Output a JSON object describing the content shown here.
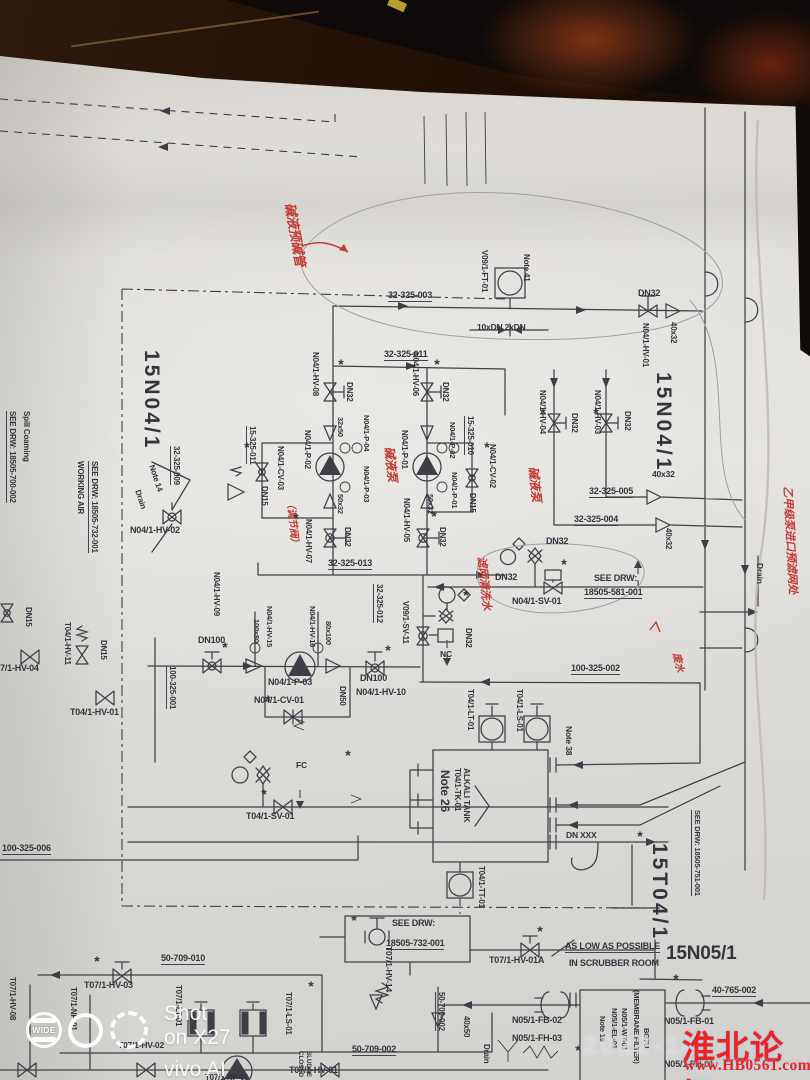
{
  "colors": {
    "ink": "#3e3e46",
    "red_pen": "#c23b33",
    "forum_red": "#ee2222",
    "paper": "#dedbd6",
    "desk": "#26140a"
  },
  "camera_watermark": {
    "badge": "WIDE",
    "line1": "Shot on X27",
    "line2": "vivo AI camera"
  },
  "forum_watermark": {
    "timestamp_partial": "2022-10-",
    "title": "淮北论坛",
    "url": "www.HB0561.com"
  },
  "diagram": {
    "labels": [
      {
        "t": "32-325-003",
        "x": 388,
        "y": 291,
        "u": 1
      },
      {
        "t": "32-325-011",
        "x": 384,
        "y": 350,
        "u": 1
      },
      {
        "t": "15N04/1",
        "x": 162,
        "y": 350,
        "r": 90,
        "s": 21,
        "ls": 3
      },
      {
        "t": "N04/1-HV-08",
        "x": 319,
        "y": 352,
        "r": 90,
        "s": 8
      },
      {
        "t": "DN32",
        "x": 353,
        "y": 382,
        "r": 90,
        "s": 8
      },
      {
        "t": "N04/1-HV-06",
        "x": 419,
        "y": 352,
        "r": 90,
        "s": 8
      },
      {
        "t": "DN32",
        "x": 449,
        "y": 382,
        "r": 90,
        "s": 8
      },
      {
        "t": "15-325-011",
        "x": 256,
        "y": 426,
        "r": 90,
        "s": 8,
        "u": 1
      },
      {
        "t": "32-325-009",
        "x": 180,
        "y": 446,
        "r": 90,
        "s": 8,
        "u": 1
      },
      {
        "t": "32x50",
        "x": 344,
        "y": 417,
        "r": 90,
        "s": 7.5
      },
      {
        "t": "N04/1-P-04",
        "x": 370,
        "y": 415,
        "r": 90,
        "s": 7.5
      },
      {
        "t": "N04/1-P-02",
        "x": 311,
        "y": 430,
        "r": 90,
        "s": 8
      },
      {
        "t": "N04/1-CV-03",
        "x": 284,
        "y": 446,
        "r": 90,
        "s": 8
      },
      {
        "t": "DN15",
        "x": 268,
        "y": 486,
        "r": 90,
        "s": 8
      },
      {
        "t": "N04/1-P-03",
        "x": 370,
        "y": 466,
        "r": 90,
        "s": 7.5
      },
      {
        "t": "50x32",
        "x": 344,
        "y": 494,
        "r": 90,
        "s": 7.5
      },
      {
        "t": "N04/1-P-01",
        "x": 408,
        "y": 430,
        "r": 90,
        "s": 8
      },
      {
        "t": "15-325-010",
        "x": 474,
        "y": 416,
        "r": 90,
        "s": 8,
        "u": 1
      },
      {
        "t": "N04/1-P-02",
        "x": 456,
        "y": 422,
        "r": 90,
        "s": 7.5
      },
      {
        "t": "N04/1-P-01",
        "x": 458,
        "y": 472,
        "r": 90,
        "s": 7.5
      },
      {
        "t": "N04/1-CV-02",
        "x": 496,
        "y": 444,
        "r": 90,
        "s": 8
      },
      {
        "t": "DN15",
        "x": 476,
        "y": 493,
        "r": 90,
        "s": 8
      },
      {
        "t": "50x32",
        "x": 434,
        "y": 494,
        "r": 90,
        "s": 7.5
      },
      {
        "t": "N04/1-HV-07",
        "x": 312,
        "y": 519,
        "r": 90,
        "s": 8
      },
      {
        "t": "DN32",
        "x": 351,
        "y": 527,
        "r": 90,
        "s": 8
      },
      {
        "t": "32-325-013",
        "x": 328,
        "y": 559,
        "u": 1
      },
      {
        "t": "N04/1-HV-05",
        "x": 410,
        "y": 498,
        "r": 90,
        "s": 8
      },
      {
        "t": "DN32",
        "x": 446,
        "y": 527,
        "r": 90,
        "s": 8
      },
      {
        "t": "V09/1-FT-01",
        "x": 488,
        "y": 250,
        "r": 90,
        "s": 8
      },
      {
        "t": "Note 41",
        "x": 530,
        "y": 254,
        "r": 90,
        "s": 8
      },
      {
        "t": "10xDN 2xDN",
        "x": 477,
        "y": 323,
        "s": 8.5
      },
      {
        "t": "DN32",
        "x": 638,
        "y": 289
      },
      {
        "t": "N04/1-HV-01",
        "x": 649,
        "y": 323,
        "r": 90,
        "s": 8
      },
      {
        "t": "40x32",
        "x": 677,
        "y": 322,
        "r": 90,
        "s": 8
      },
      {
        "t": "15N04/1",
        "x": 674,
        "y": 372,
        "r": 90,
        "s": 21,
        "ls": 3
      },
      {
        "t": "N04/1-HV-04",
        "x": 546,
        "y": 390,
        "r": 90,
        "s": 8
      },
      {
        "t": "DN32",
        "x": 578,
        "y": 413,
        "r": 90,
        "s": 8
      },
      {
        "t": "N04/1-HV-03",
        "x": 601,
        "y": 390,
        "r": 90,
        "s": 8
      },
      {
        "t": "DN32",
        "x": 631,
        "y": 411,
        "r": 90,
        "s": 8
      },
      {
        "t": "40x32",
        "x": 652,
        "y": 470,
        "s": 8.5
      },
      {
        "t": "32-325-005",
        "x": 589,
        "y": 487,
        "u": 1
      },
      {
        "t": "32-325-004",
        "x": 574,
        "y": 515,
        "u": 1
      },
      {
        "t": "40x32",
        "x": 672,
        "y": 528,
        "r": 90,
        "s": 8
      },
      {
        "t": "DN32",
        "x": 546,
        "y": 537
      },
      {
        "t": "DN32",
        "x": 495,
        "y": 573
      },
      {
        "t": "SEE DRW:",
        "x": 594,
        "y": 574
      },
      {
        "t": "18505-581-001",
        "x": 584,
        "y": 588,
        "u": 1
      },
      {
        "t": "N04/1-SV-01",
        "x": 512,
        "y": 597
      },
      {
        "t": "32-325-012",
        "x": 383,
        "y": 584,
        "r": 90,
        "s": 8,
        "u": 1
      },
      {
        "t": "V09/1-SV-11",
        "x": 409,
        "y": 601,
        "r": 90,
        "s": 8
      },
      {
        "t": "DN32",
        "x": 472,
        "y": 628,
        "r": 90,
        "s": 8
      },
      {
        "t": "NC",
        "x": 440,
        "y": 650,
        "s": 8.5
      },
      {
        "t": "100-325-002",
        "x": 571,
        "y": 664,
        "u": 1
      },
      {
        "t": "DN100",
        "x": 360,
        "y": 674
      },
      {
        "t": "N04/1-HV-10",
        "x": 356,
        "y": 688
      },
      {
        "t": "DN100",
        "x": 198,
        "y": 636
      },
      {
        "t": "100-325-001",
        "x": 176,
        "y": 666,
        "r": 90,
        "s": 8,
        "u": 1
      },
      {
        "t": "100x80",
        "x": 260,
        "y": 619,
        "r": 90,
        "s": 7.5
      },
      {
        "t": "N04/1-HV-15",
        "x": 273,
        "y": 606,
        "r": 90,
        "s": 7.5
      },
      {
        "t": "80x100",
        "x": 332,
        "y": 621,
        "r": 90,
        "s": 7.5
      },
      {
        "t": "N04/1-HV-16",
        "x": 316,
        "y": 606,
        "r": 90,
        "s": 7.5
      },
      {
        "t": "N04/1-P-03",
        "x": 268,
        "y": 678
      },
      {
        "t": "N04/1-CV-01",
        "x": 254,
        "y": 696
      },
      {
        "t": "DN50",
        "x": 346,
        "y": 686,
        "r": 90,
        "s": 8
      },
      {
        "t": "FC",
        "x": 296,
        "y": 761,
        "s": 8.5
      },
      {
        "t": "T04/1-SV-01",
        "x": 246,
        "y": 812
      },
      {
        "t": "100-325-006",
        "x": 2,
        "y": 844,
        "u": 1
      },
      {
        "t": "Spill Coaming",
        "x": 30,
        "y": 411,
        "r": 90,
        "s": 8
      },
      {
        "t": "SEE DRW: 18505-700-002",
        "x": 16,
        "y": 411,
        "r": 90,
        "s": 8,
        "u": 1
      },
      {
        "t": "WORKING AIR",
        "x": 84,
        "y": 461,
        "r": 90,
        "s": 8
      },
      {
        "t": "SEE DRW: 18505-732-001",
        "x": 98,
        "y": 461,
        "r": 90,
        "s": 8,
        "u": 1
      },
      {
        "t": "Note 14",
        "x": 155,
        "y": 464,
        "r": 72,
        "s": 8
      },
      {
        "t": "Drain",
        "x": 141,
        "y": 489,
        "r": 72,
        "s": 8
      },
      {
        "t": "N04/1-HV-02",
        "x": 130,
        "y": 526
      },
      {
        "t": "N04/1-HV-09",
        "x": 220,
        "y": 572,
        "r": 90,
        "s": 8
      },
      {
        "t": "DN15",
        "x": 32,
        "y": 607,
        "r": 90,
        "s": 8
      },
      {
        "t": "T04/1-HV-11",
        "x": 71,
        "y": 622,
        "r": 90,
        "s": 8
      },
      {
        "t": "DN15",
        "x": 107,
        "y": 640,
        "r": 90,
        "s": 8
      },
      {
        "t": "7/1-HV-04",
        "x": 0,
        "y": 664
      },
      {
        "t": "T04/1-HV-01",
        "x": 70,
        "y": 708
      },
      {
        "t": "T04/1-LT-01",
        "x": 474,
        "y": 689,
        "r": 90,
        "s": 8
      },
      {
        "t": "T04/1-LS-01",
        "x": 523,
        "y": 689,
        "r": 90,
        "s": 8
      },
      {
        "t": "Note 38",
        "x": 573,
        "y": 726,
        "r": 90,
        "s": 8.5
      },
      {
        "t": "ALKALI TANK",
        "x": 471,
        "y": 768,
        "r": 90,
        "s": 8.5,
        "b": 1
      },
      {
        "t": "T04/1-TK-01",
        "x": 461,
        "y": 768,
        "r": 90,
        "s": 8
      },
      {
        "t": "Note 26",
        "x": 451,
        "y": 770,
        "r": 90,
        "s": 12
      },
      {
        "t": "DN XXX",
        "x": 566,
        "y": 831,
        "s": 8.5
      },
      {
        "t": "15T04/1",
        "x": 670,
        "y": 843,
        "r": 90,
        "s": 21,
        "ls": 3
      },
      {
        "t": "SEE DRW: 18505-751-001",
        "x": 701,
        "y": 810,
        "r": 90,
        "s": 7.5,
        "u": 1
      },
      {
        "t": "T04/1-TT-01",
        "x": 485,
        "y": 866,
        "r": 90,
        "s": 8
      },
      {
        "t": "Drain",
        "x": 764,
        "y": 563,
        "r": 90,
        "s": 8.5
      },
      {
        "t": "SEE DRW:",
        "x": 392,
        "y": 919
      },
      {
        "t": "18505-732-001",
        "x": 386,
        "y": 939,
        "u": 1
      },
      {
        "t": "T07/1-HV-14",
        "x": 393,
        "y": 946,
        "r": 90,
        "s": 8.5,
        "b": 1
      },
      {
        "t": "50-709-010",
        "x": 161,
        "y": 954,
        "u": 1
      },
      {
        "t": "T07/1-HV-03",
        "x": 84,
        "y": 981
      },
      {
        "t": "T07/1-HV-01A",
        "x": 489,
        "y": 956
      },
      {
        "t": "AS LOW AS POSSIBLE",
        "x": 565,
        "y": 942,
        "b": 1,
        "u": 1
      },
      {
        "t": "IN SCRUBBER ROOM",
        "x": 569,
        "y": 959,
        "b": 1
      },
      {
        "t": "15N05/1",
        "x": 666,
        "y": 944,
        "s": 19
      },
      {
        "t": "40-765-002",
        "x": 712,
        "y": 986,
        "u": 1
      },
      {
        "t": "N05/1-FB-02",
        "x": 512,
        "y": 1016
      },
      {
        "t": "N05/1-FH-03",
        "x": 512,
        "y": 1034
      },
      {
        "t": "N05/1-FB-01",
        "x": 664,
        "y": 1017
      },
      {
        "t": "N05/1-FH-01",
        "x": 664,
        "y": 1060
      },
      {
        "t": "40x50",
        "x": 470,
        "y": 1016,
        "r": 90,
        "s": 8
      },
      {
        "t": "Drain",
        "x": 490,
        "y": 1044,
        "r": 90,
        "s": 8
      },
      {
        "t": "50-709-002",
        "x": 352,
        "y": 1045,
        "u": 1
      },
      {
        "t": "T07/1-HV-01",
        "x": 289,
        "y": 1066
      },
      {
        "t": "50-709-002",
        "x": 445,
        "y": 992,
        "r": 90,
        "s": 8,
        "u": 1
      },
      {
        "t": "T07/1-HV-08",
        "x": 16,
        "y": 977,
        "r": 90,
        "s": 8
      },
      {
        "t": "T07/1-NP-01",
        "x": 77,
        "y": 987,
        "r": 90,
        "s": 8
      },
      {
        "t": "T07/1-LT-01",
        "x": 182,
        "y": 985,
        "r": 90,
        "s": 8
      },
      {
        "t": "T07/1-LS-01",
        "x": 292,
        "y": 992,
        "r": 90,
        "s": 8
      },
      {
        "t": "CLOSED",
        "x": 303,
        "y": 1051,
        "r": 90,
        "s": 6.5
      },
      {
        "t": "SLUDGE",
        "x": 311,
        "y": 1051,
        "r": 90,
        "s": 6.5
      },
      {
        "t": "T07/1-HV-02",
        "x": 118,
        "y": 1041,
        "s": 8.5
      },
      {
        "t": "T07/1-NP-01",
        "x": 205,
        "y": 1074,
        "s": 8
      },
      {
        "t": "BG7U",
        "x": 650,
        "y": 1028,
        "r": 90,
        "s": 7.5
      },
      {
        "t": "(MEMBRANE FILTER)",
        "x": 640,
        "y": 990,
        "r": 90,
        "s": 7.5
      },
      {
        "t": "N05/1-WT-01",
        "x": 628,
        "y": 1008,
        "r": 90,
        "s": 7.5
      },
      {
        "t": "N05/1-EL-01",
        "x": 618,
        "y": 1008,
        "r": 90,
        "s": 7.5
      },
      {
        "t": "Note 19",
        "x": 606,
        "y": 1016,
        "r": 90,
        "s": 7.5
      },
      {
        "t": "碱液预碱管",
        "x": 296,
        "y": 202,
        "r": 80,
        "s": 13,
        "c": "red"
      },
      {
        "t": "碱液泵",
        "x": 395,
        "y": 446,
        "r": 84,
        "s": 12,
        "c": "red"
      },
      {
        "t": "碱液泵",
        "x": 539,
        "y": 466,
        "r": 84,
        "s": 12,
        "c": "red"
      },
      {
        "t": "（调节阀）",
        "x": 294,
        "y": 498,
        "r": 84,
        "s": 10,
        "c": "red"
      },
      {
        "t": "滤网清洗水",
        "x": 486,
        "y": 556,
        "r": 84,
        "s": 11,
        "c": "red"
      },
      {
        "t": "乙甲级泵进口预滤网处",
        "x": 792,
        "y": 486,
        "r": 87,
        "s": 11,
        "c": "red"
      },
      {
        "t": "废水",
        "x": 680,
        "y": 652,
        "r": 78,
        "s": 10,
        "c": "red"
      }
    ],
    "asterisk_marks": [
      [
        341,
        364
      ],
      [
        437,
        364
      ],
      [
        247,
        447
      ],
      [
        487,
        447
      ],
      [
        296,
        518
      ],
      [
        434,
        516
      ],
      [
        564,
        564
      ],
      [
        466,
        595
      ],
      [
        225,
        647
      ],
      [
        388,
        650
      ],
      [
        268,
        700
      ],
      [
        348,
        755
      ],
      [
        97,
        961
      ],
      [
        540,
        931
      ],
      [
        676,
        979
      ],
      [
        578,
        1050
      ],
      [
        311,
        986
      ],
      [
        543,
        413
      ],
      [
        596,
        413
      ],
      [
        354,
        920
      ],
      [
        640,
        836
      ],
      [
        264,
        794
      ]
    ]
  }
}
